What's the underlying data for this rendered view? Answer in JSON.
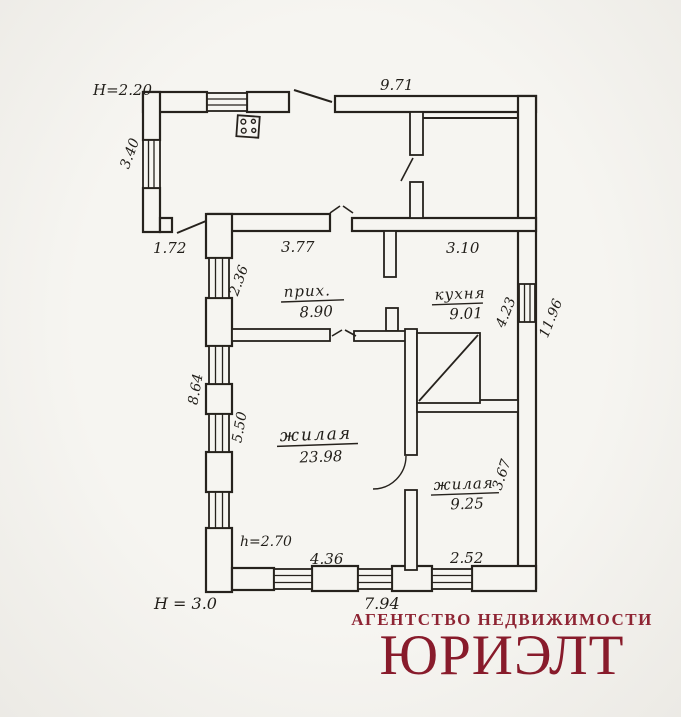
{
  "colors": {
    "brand": "#8c1f2e",
    "ink": "#26221d",
    "paper": "#f6f5f1"
  },
  "plan": {
    "heights": {
      "veranda": "Н=2.20",
      "building": "Н = 3.0",
      "interior": "h=2.70"
    },
    "dimensions": {
      "top_width": "9.71",
      "veranda_wall": "3.40",
      "veranda_door": "1.72",
      "hallway_top": "3.77",
      "kitchen_top": "3.10",
      "hallway_left": "2.36",
      "left_outer": "8.64",
      "living_left": "5.50",
      "kitchen_right": "4.23",
      "right_outer": "11.96",
      "living_small_right": "3.67",
      "living_bottom": "4.36",
      "living_small_bottom": "2.52",
      "bottom_outer": "7.94"
    },
    "rooms": {
      "hallway": {
        "label": "прих.",
        "area": "8.90"
      },
      "kitchen": {
        "label": "кухня",
        "area": "9.01"
      },
      "living_large": {
        "label": "жилая",
        "area": "23.98"
      },
      "living_small": {
        "label": "жилая",
        "area": "9.25"
      }
    }
  },
  "branding": {
    "tagline": "АГЕНТСТВО НЕДВИЖИМОСТИ",
    "name": "ЮРИЭЛТ"
  }
}
